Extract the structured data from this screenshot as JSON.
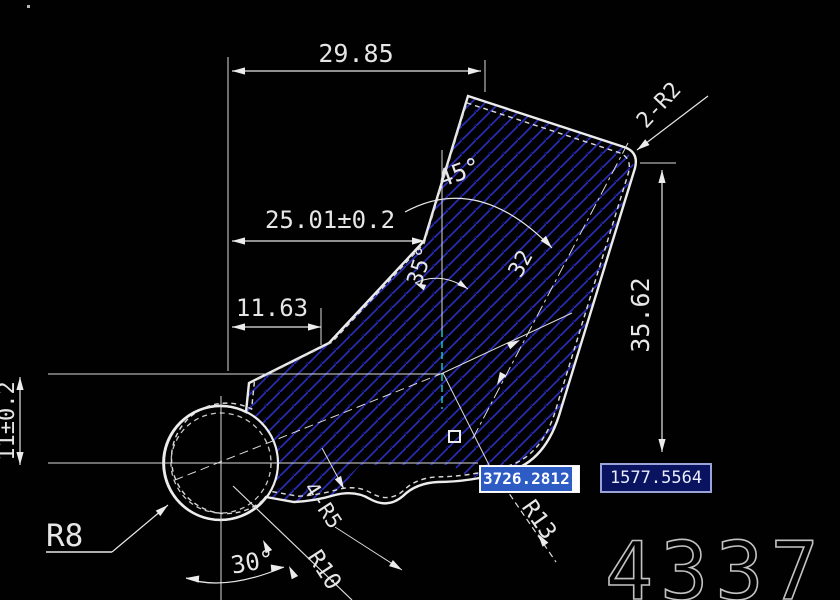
{
  "app": {
    "background": "#010101",
    "type": "cad-drawing-view"
  },
  "drawing": {
    "dimensions": {
      "width_top": "29.85",
      "width_mid": "25.01±0.2",
      "width_small": "11.63",
      "height_left": "11±0.2",
      "height_right": "35.62",
      "angle_top": "45°",
      "angle_mid": "35°",
      "angle_bottom": "30°",
      "body_width": "32",
      "radius_boss": "R8",
      "radius_fillets": "4-R5",
      "radius_bottom": "R10",
      "radius_corner": "R13",
      "corner_note": "2-R2"
    },
    "colors": {
      "outline": "#e8e8e8",
      "hatch_bright": "#272cb4",
      "hatch_dim": "#12126b",
      "centerline_accent": "#19d0d0",
      "selection": "#2e5cc5",
      "tooltip_bg": "#0a135f"
    }
  },
  "dynamic_input": {
    "x_value": "3726.2812",
    "y_value": "1577.5564"
  },
  "watermark": {
    "text": "4337"
  }
}
